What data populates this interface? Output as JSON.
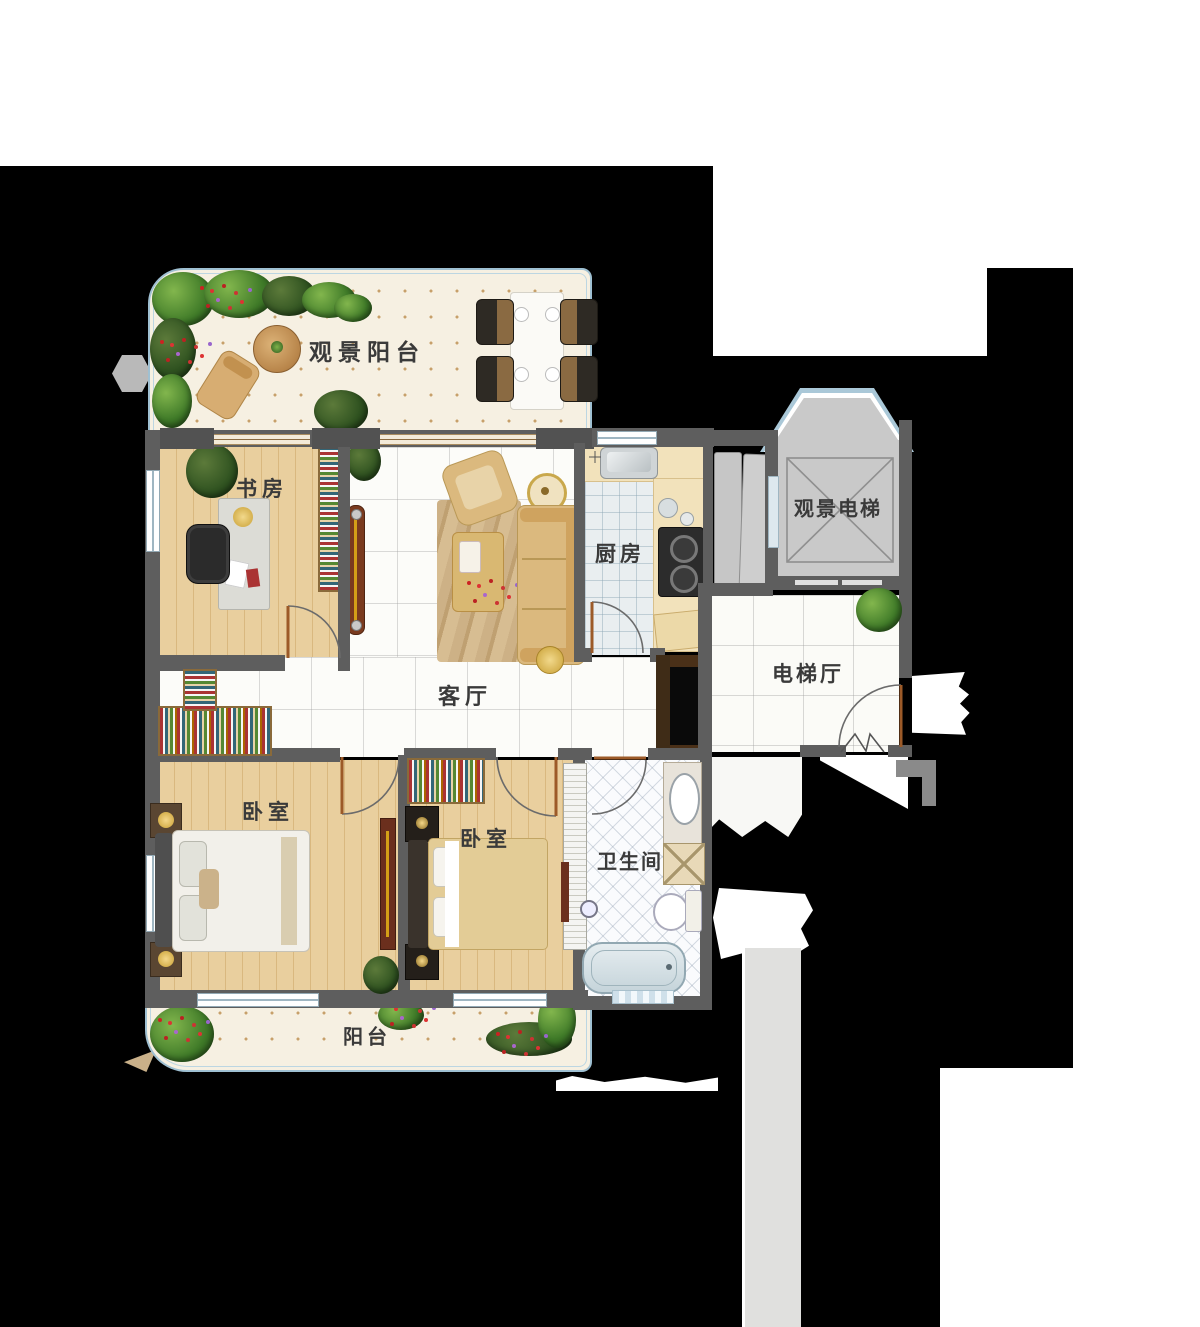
{
  "rooms": {
    "balcony_top": {
      "label": "观景阳台"
    },
    "study": {
      "label": "书房"
    },
    "living": {
      "label": "客厅"
    },
    "kitchen": {
      "label": "厨房"
    },
    "elevator": {
      "label": "观景电梯"
    },
    "elevator_hall": {
      "label": "电梯厅"
    },
    "bedroom_left": {
      "label": "卧室"
    },
    "bedroom_right": {
      "label": "卧室"
    },
    "bathroom": {
      "label": "卫生间"
    },
    "balcony_bottom": {
      "label": "阳台"
    }
  },
  "palette": {
    "background": "#000000",
    "paper": "#ffffff",
    "wall": "#5e5e5e",
    "wood_floor": "#e3c68f",
    "marble": "#fbfbf8",
    "glass": "#a9c7d6",
    "balcony_floor": "#f6f0e2",
    "elevator_cab": "#c9c9c9",
    "sofa": "#dbb97e",
    "plant_green": "#3f7a28"
  }
}
